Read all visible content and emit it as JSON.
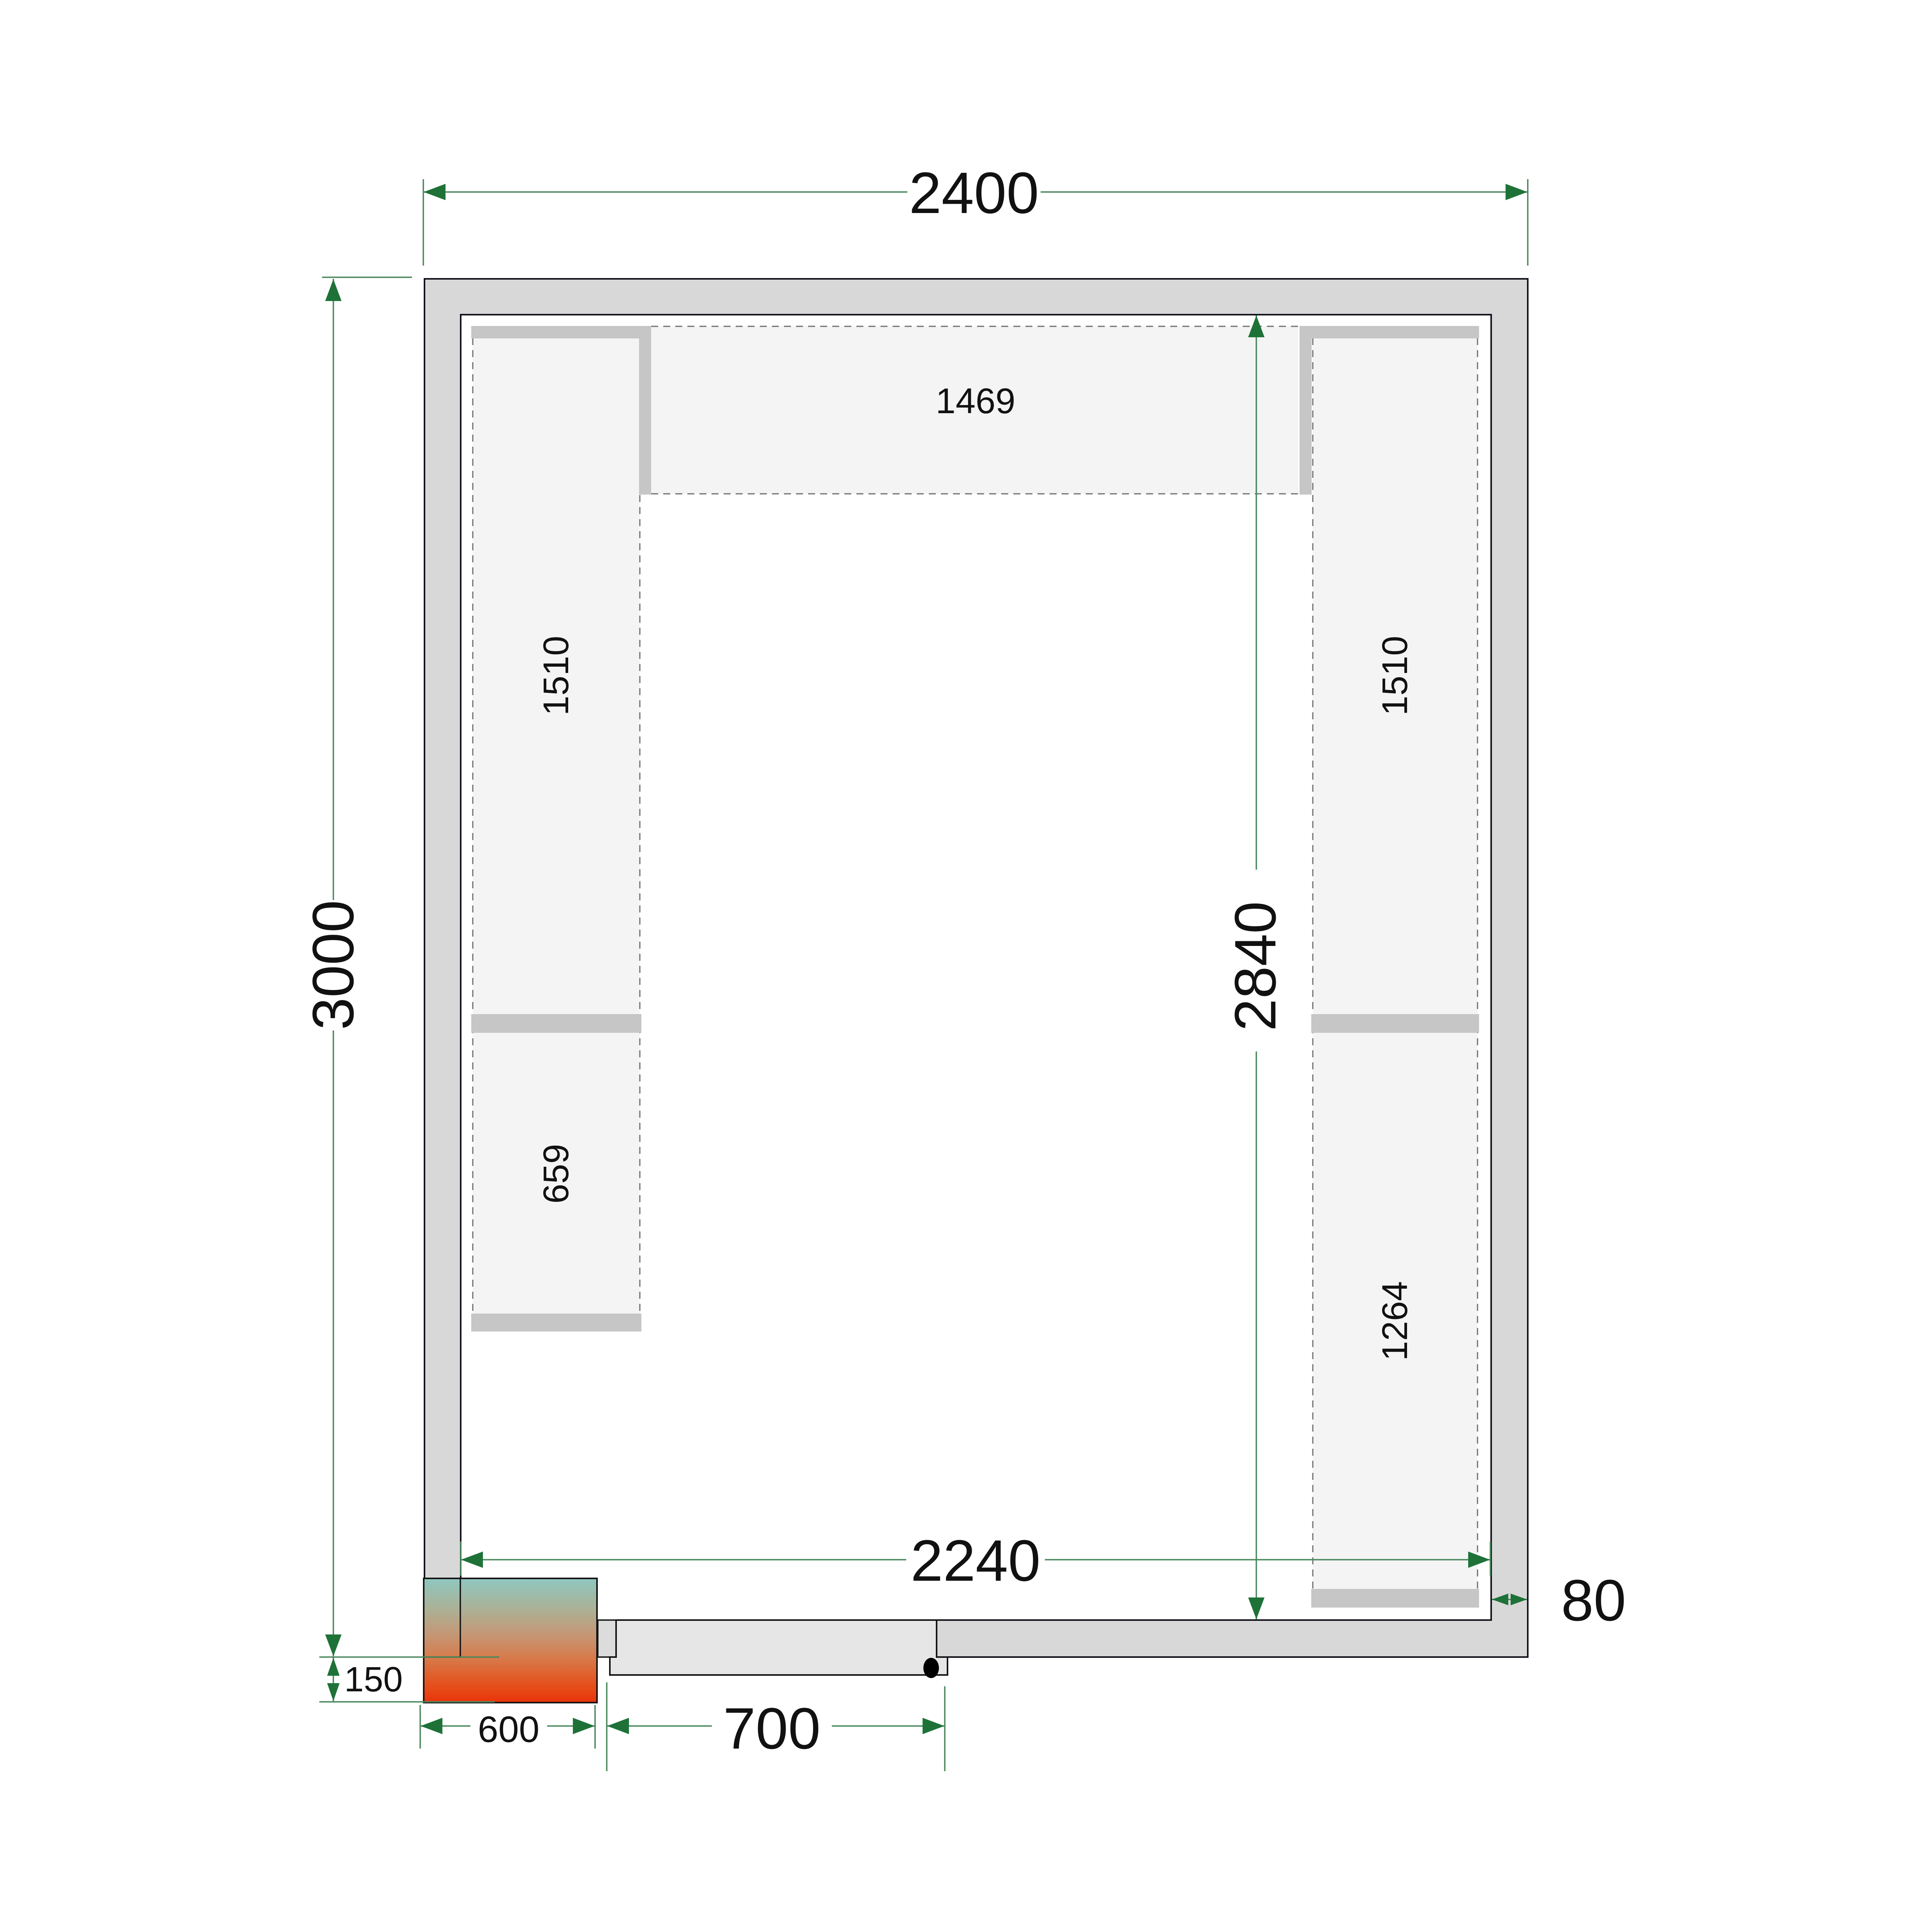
{
  "drawing": {
    "type": "cold-room-floor-plan-top-view",
    "units": "mm"
  },
  "dimensions": {
    "outer_width": "2400",
    "outer_depth": "3000",
    "inner_width": "2240",
    "inner_depth": "2840",
    "wall_thickness": "80",
    "unit_protrusion": "150",
    "unit_width": "600",
    "door_width": "700"
  },
  "shelves": {
    "top": "1469",
    "left_upper": "1510",
    "left_lower": "659",
    "right_upper": "1510",
    "right_lower": "1264"
  },
  "colors": {
    "dimension_line_green": "#48875c",
    "arrow_green": "#1e7238",
    "wall_fill": "#d8d8d8",
    "wall_outline": "#13111a",
    "shelf_fill": "#f4f4f4",
    "shelf_dash": "#6e6e6e",
    "support_bar": "#c6c6c6",
    "door_fill": "#e6e6e6",
    "door_frame_fill": "#dcdcdc",
    "unit_gradient_top": "#8ec7c1",
    "unit_gradient_middle": "#c49776",
    "unit_gradient_bottom": "#ea330b"
  }
}
